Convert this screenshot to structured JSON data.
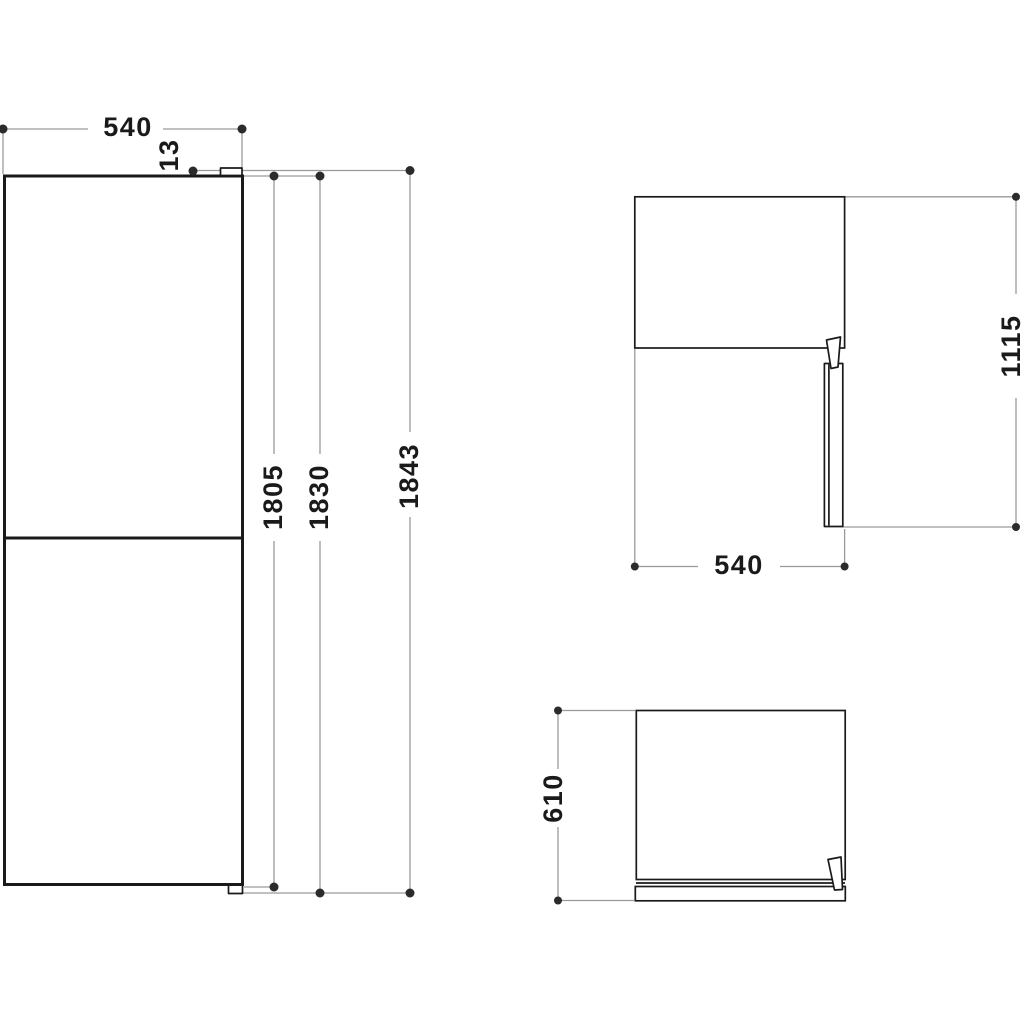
{
  "diagram": {
    "kind": "appliance-dimension-drawing",
    "colors": {
      "background": "#ffffff",
      "object_line": "#1a1a1a",
      "dimension_line": "#9a9a9a",
      "marker_dot": "#2b2b2b",
      "text": "#1a1a1a"
    },
    "views": {
      "front": {
        "labels": {
          "width": "540",
          "hinge_height": "13",
          "height_min": "1805",
          "height_mid": "1830",
          "height_max": "1843"
        }
      },
      "side": {
        "labels": {
          "height": "1115",
          "depth": "540"
        }
      },
      "top": {
        "labels": {
          "depth": "610"
        }
      }
    }
  }
}
